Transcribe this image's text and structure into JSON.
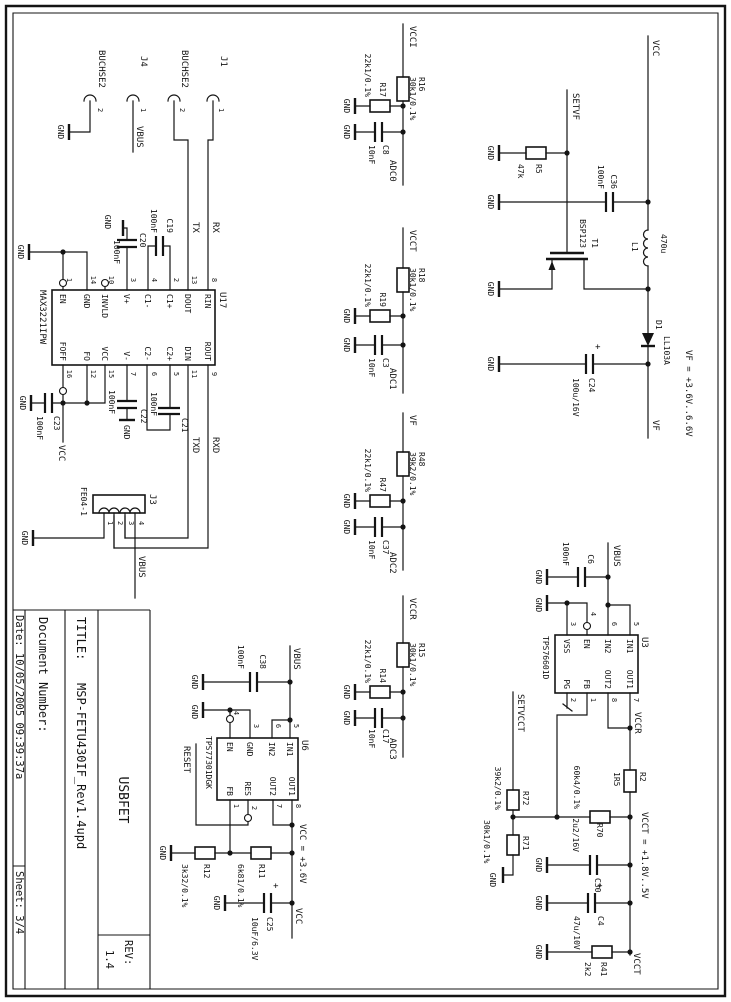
{
  "nets": {
    "gnd": "GND",
    "vcc": "VCC",
    "vbus": "VBUS",
    "rx": "RX",
    "tx": "TX",
    "rxd": "RXD",
    "txd": "TXD",
    "vcci": "VCCI",
    "vcct": "VCCT",
    "vccr": "VCCR",
    "vf": "VF",
    "setvf": "SETVF",
    "setvcct": "SETVCCT",
    "reset": "RESET",
    "plus": "+"
  },
  "notes": {
    "vf_range": "VF = +3.6V..6.6V",
    "vcct_range": "VCCT = +1.8V..5V",
    "vcc_value": "VCC = +3.6V"
  },
  "connectors": {
    "j1": {
      "ref": "J1",
      "pin": "1"
    },
    "buchse_tx": {
      "ref": "BUCHSE2",
      "pin": "2"
    },
    "j4": {
      "ref": "J4",
      "pin": "1"
    },
    "buchse_gnd": {
      "ref": "BUCHSE2",
      "pin": "2"
    },
    "j3": {
      "ref": "J3",
      "value": "FE04-1",
      "pins": [
        "4",
        "3",
        "2",
        "1"
      ]
    }
  },
  "u17": {
    "ref": "U17",
    "value": "MAX3221IPW",
    "left": [
      {
        "n": "8",
        "l": "RIN"
      },
      {
        "n": "13",
        "l": "DOUT"
      },
      {
        "n": "2",
        "l": "C1+"
      },
      {
        "n": "4",
        "l": "C1-"
      },
      {
        "n": "3",
        "l": "V+"
      },
      {
        "n": "10",
        "l": "INVLD"
      },
      {
        "n": "14",
        "l": "GND"
      },
      {
        "n": "1",
        "l": "EN"
      }
    ],
    "right": [
      {
        "n": "9",
        "l": "ROUT"
      },
      {
        "n": "11",
        "l": "DIN"
      },
      {
        "n": "5",
        "l": "C2+"
      },
      {
        "n": "6",
        "l": "C2-"
      },
      {
        "n": "7",
        "l": "V-"
      },
      {
        "n": "15",
        "l": "VCC"
      },
      {
        "n": "12",
        "l": "FO"
      },
      {
        "n": "16",
        "l": "FOFF"
      }
    ]
  },
  "u3": {
    "ref": "U3",
    "value": "TPS76601D",
    "left": [
      {
        "n": "5",
        "l": "IN1"
      },
      {
        "n": "6",
        "l": "IN2"
      },
      {
        "n": "4",
        "l": "EN"
      },
      {
        "n": "3",
        "l": "VSS"
      }
    ],
    "right": [
      {
        "n": "7",
        "l": "OUT1"
      },
      {
        "n": "8",
        "l": "OUT2"
      },
      {
        "n": "1",
        "l": "FB"
      },
      {
        "n": "2",
        "l": "PG"
      }
    ]
  },
  "u6": {
    "ref": "U6",
    "value": "TPS77301DGK",
    "left": [
      {
        "n": "5",
        "l": "IN1"
      },
      {
        "n": "6",
        "l": "IN2"
      },
      {
        "n": "3",
        "l": "GND"
      },
      {
        "n": "4",
        "l": "EN"
      }
    ],
    "right": [
      {
        "n": "8",
        "l": "OUT1"
      },
      {
        "n": "7",
        "l": "OUT2"
      },
      {
        "n": "2",
        "l": "RES"
      },
      {
        "n": "1",
        "l": "FB"
      }
    ]
  },
  "adc": [
    {
      "net": "VCCI",
      "rs_ref": "R16",
      "rs_val": "30k1/0.1%",
      "rp_ref": "R17",
      "rp_val": "22k1/0.1%",
      "c_ref": "C8",
      "c_val": "10nF",
      "out": "ADC0"
    },
    {
      "net": "VCCT",
      "rs_ref": "R18",
      "rs_val": "30k1/0.1%",
      "rp_ref": "R19",
      "rp_val": "22k1/0.1%",
      "c_ref": "C3",
      "c_val": "10nF",
      "out": "ADC1"
    },
    {
      "net": "VF",
      "rs_ref": "R48",
      "rs_val": "39k2/0.1%",
      "rp_ref": "R47",
      "rp_val": "22k1/0.1%",
      "c_ref": "C37",
      "c_val": "10nF",
      "out": "ADC2"
    },
    {
      "net": "VCCR",
      "rs_ref": "R15",
      "rs_val": "30k1/0.1%",
      "rp_ref": "R14",
      "rp_val": "22k1/0.1%",
      "c_ref": "C17",
      "c_val": "10nF",
      "out": "ADC3"
    }
  ],
  "parts": {
    "c19": {
      "ref": "C19",
      "val": "100nF"
    },
    "c20": {
      "ref": "C20",
      "val": "100nF"
    },
    "c21": {
      "ref": "C21",
      "val": "100nF"
    },
    "c22": {
      "ref": "C22",
      "val": "100nF"
    },
    "c23": {
      "ref": "C23",
      "val": "100nF"
    },
    "r5": {
      "ref": "R5",
      "val": "47k"
    },
    "c36": {
      "ref": "C36",
      "val": "100nF"
    },
    "t1": {
      "ref": "T1",
      "val": "BSP123"
    },
    "l1": {
      "ref": "L1",
      "val": "470u"
    },
    "d1": {
      "ref": "D1",
      "val": "LL103A"
    },
    "c24": {
      "ref": "C24",
      "val": "100u/16V"
    },
    "c6": {
      "ref": "C6",
      "val": "100nF"
    },
    "r2": {
      "ref": "R2",
      "val": "1R5"
    },
    "r70": {
      "ref": "R70",
      "val": "60k4/0.1%"
    },
    "r71": {
      "ref": "R71",
      "val": "30k1/0.1%"
    },
    "r72": {
      "ref": "R72",
      "val": "39k2/0.1%"
    },
    "c30": {
      "ref": "C30",
      "val": "2u2/16V"
    },
    "c4": {
      "ref": "C4",
      "val": "47u/10V"
    },
    "r41": {
      "ref": "R41",
      "val": "2k2"
    },
    "c38": {
      "ref": "C38",
      "val": "100nF"
    },
    "r11": {
      "ref": "R11",
      "val": "6k81/0.1%"
    },
    "r12": {
      "ref": "R12",
      "val": "3k32/0.1%"
    },
    "c25": {
      "ref": "C25",
      "val": "10uF/6.3V"
    }
  },
  "title_block": {
    "doc_name": "USBFET",
    "rev_label": "REV:",
    "rev": "1.4",
    "title_label": "TITLE:",
    "title": "MSP-FETU430IF_Rev1.4upd",
    "doc_label": "Document Number:",
    "date": "Date: 10/05/2005 09:39:37a",
    "sheet": "Sheet: 3/4"
  }
}
